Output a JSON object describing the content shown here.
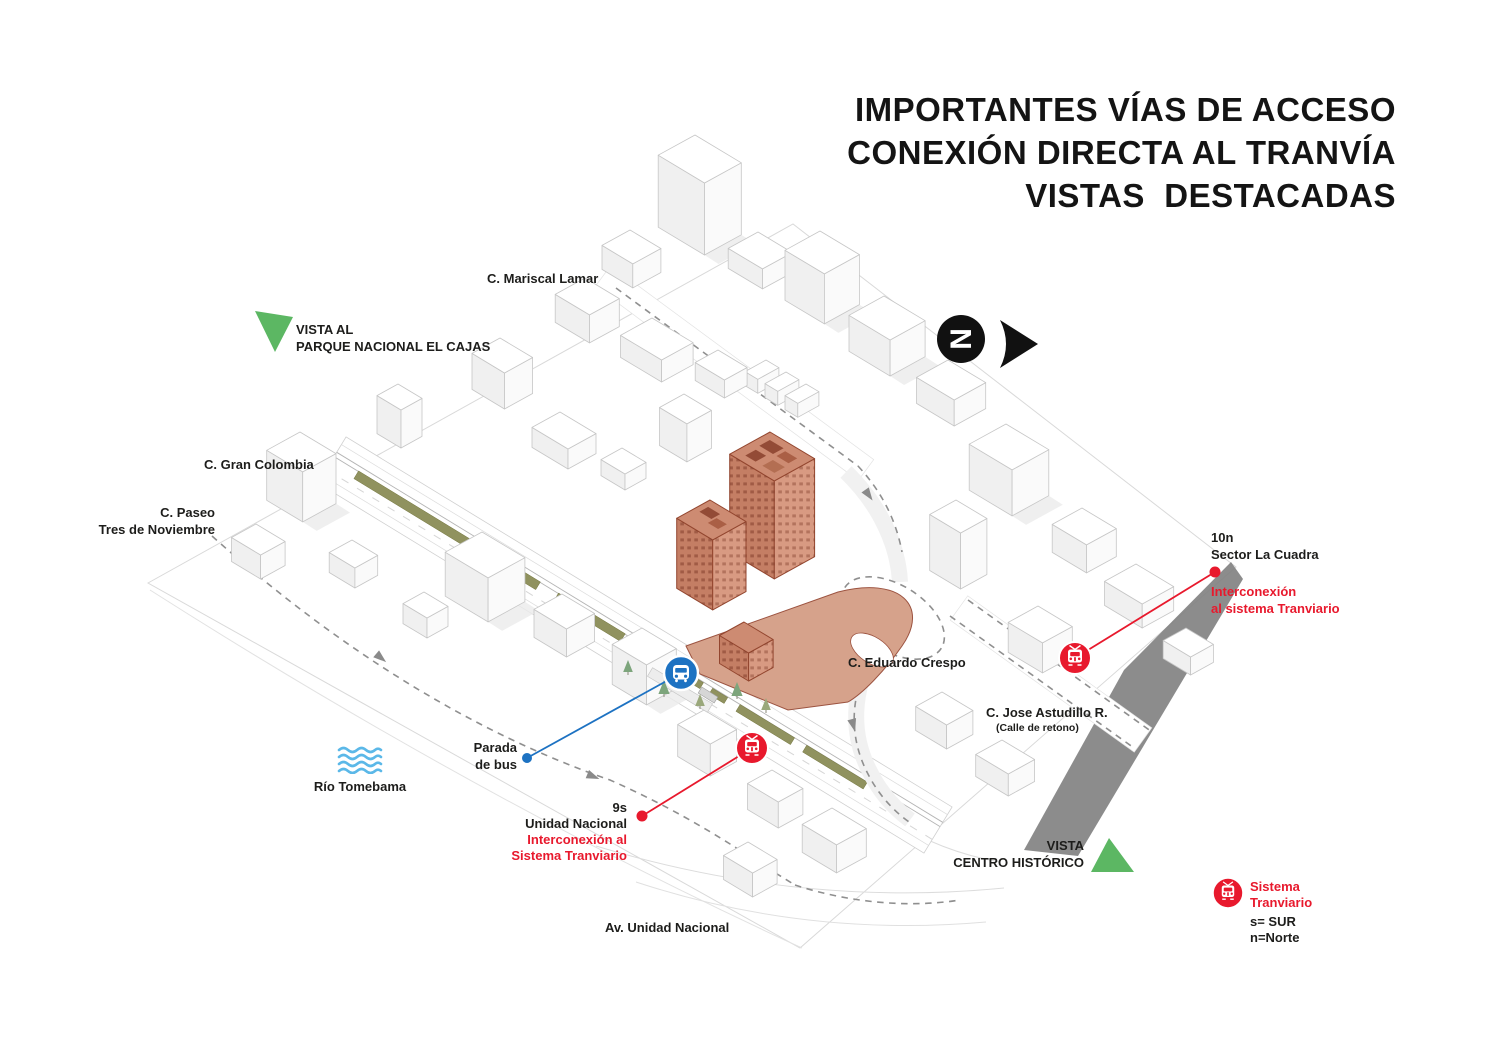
{
  "title": {
    "line1": "IMPORTANTES VÍAS DE ACCESO",
    "line2": "CONEXIÓN DIRECTA AL TRANVÍA",
    "line3": "VISTAS  DESTACADAS"
  },
  "north_indicator": {
    "letter": "N"
  },
  "views": {
    "cajas": {
      "line1": "VISTA AL",
      "line2": "PARQUE NACIONAL EL CAJAS"
    },
    "centro_historico": {
      "line1": "VISTA",
      "line2": "CENTRO HISTÓRICO"
    }
  },
  "streets": {
    "mariscal_lamar": "C. Mariscal Lamar",
    "gran_colombia": "C. Gran Colombia",
    "paseo_line1": "C. Paseo",
    "paseo_line2": "Tres de Noviembre",
    "eduardo_crespo": "C. Eduardo Crespo",
    "jose_astudillo": "C. Jose Astudillo R.",
    "jose_astudillo_note": "(Calle de retono)",
    "av_unidad_nacional": "Av. Unidad Nacional"
  },
  "river": {
    "label": "Río Tomebama"
  },
  "bus_stop": {
    "line1": "Parada",
    "line2": "de bus"
  },
  "tram_stops": {
    "unidad_nacional": {
      "code": "9s",
      "name": "Unidad Nacional",
      "note_line1": "Interconexión al",
      "note_line2": "Sistema Tranviario"
    },
    "la_cuadra": {
      "code": "10n",
      "name": "Sector La Cuadra",
      "note_line1": "Interconexión",
      "note_line2": "al sistema Tranviario"
    }
  },
  "legend": {
    "line1": "Sistema",
    "line2": "Tranviario",
    "line3": "s= SUR",
    "line4": "n=Norte"
  },
  "colors": {
    "accent_red": "#e8192d",
    "accent_blue": "#1d72c2",
    "view_green": "#5cb763",
    "water_blue": "#5bb8e8",
    "highlight_building": "#cd8b72",
    "median_olive": "#90925f"
  }
}
